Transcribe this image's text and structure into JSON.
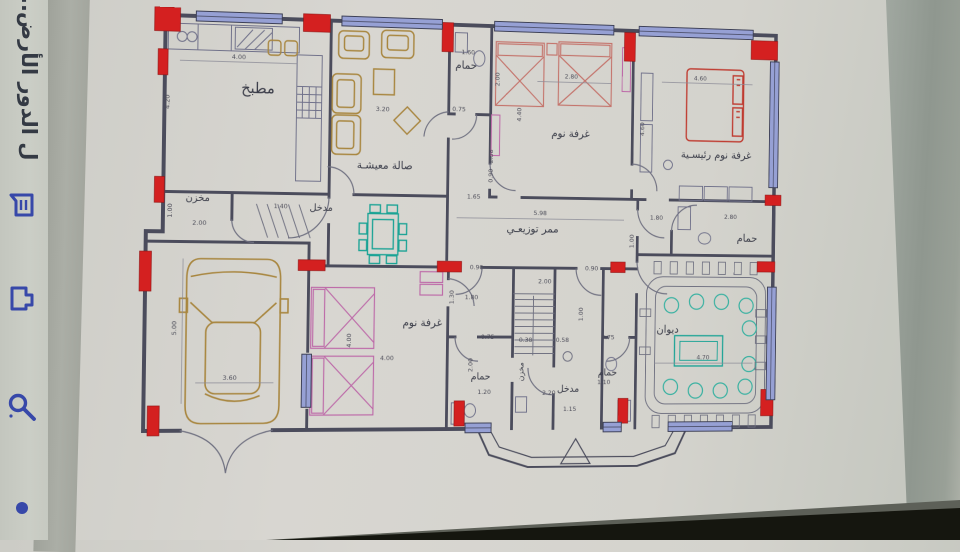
{
  "viewer": {
    "title_vertical": "ل الدور الأرض...",
    "icons": [
      {
        "name": "annotation-icon"
      },
      {
        "name": "share-icon"
      },
      {
        "name": "search-icon"
      },
      {
        "name": "dot-indicator"
      }
    ],
    "icon_color": "#3748a9"
  },
  "plan": {
    "rooms": [
      {
        "id": "kitchen",
        "label": "مطبخ",
        "x": 120,
        "y": 84,
        "s": 15,
        "r": 0
      },
      {
        "id": "living",
        "label": "صالة معيشـة",
        "x": 253,
        "y": 158,
        "s": 11,
        "r": 0
      },
      {
        "id": "bath-top",
        "label": "حمام",
        "x": 338,
        "y": 53,
        "s": 11,
        "r": 0
      },
      {
        "id": "bedroom-1",
        "label": "غرفة نوم",
        "x": 452,
        "y": 121,
        "s": 11,
        "r": 0
      },
      {
        "id": "master-bedroom",
        "label": "غرفة نوم رئيسـية",
        "x": 614,
        "y": 140,
        "s": 11,
        "r": 0
      },
      {
        "id": "store-1",
        "label": "مخزن",
        "x": 60,
        "y": 194,
        "s": 10,
        "r": 0
      },
      {
        "id": "entry-1",
        "label": "مدخل",
        "x": 187,
        "y": 202,
        "s": 10,
        "r": 0
      },
      {
        "id": "corridor",
        "label": "ممر توزيعـي",
        "x": 412,
        "y": 221,
        "s": 11,
        "r": 0
      },
      {
        "id": "bath-right",
        "label": "حمام",
        "x": 650,
        "y": 228,
        "s": 11,
        "r": 0
      },
      {
        "id": "bedroom-2",
        "label": "غرفة نوم",
        "x": 295,
        "y": 319,
        "s": 11,
        "r": 0
      },
      {
        "id": "diwan",
        "label": "ديوان",
        "x": 562,
        "y": 325,
        "s": 11,
        "r": 0
      },
      {
        "id": "bath-3",
        "label": "حمام",
        "x": 358,
        "y": 374,
        "s": 10,
        "r": 0
      },
      {
        "id": "store-2",
        "label": "مخزن",
        "x": 404,
        "y": 366,
        "s": 8,
        "r": -90
      },
      {
        "id": "entry-2",
        "label": "مدخل",
        "x": 453,
        "y": 387,
        "s": 10,
        "r": 0
      },
      {
        "id": "bath-4",
        "label": "حمام",
        "x": 496,
        "y": 370,
        "s": 10,
        "r": 0
      }
    ],
    "dims": [
      {
        "t": "4.00",
        "x": 100,
        "y": 50,
        "r": 0
      },
      {
        "t": "4.20",
        "x": 30,
        "y": 95,
        "r": 1
      },
      {
        "t": "3.20",
        "x": 250,
        "y": 99,
        "r": 0
      },
      {
        "t": "0.75",
        "x": 331,
        "y": 97,
        "r": 0
      },
      {
        "t": "1.60",
        "x": 340,
        "y": 38,
        "r": 0
      },
      {
        "t": "2.00",
        "x": 374,
        "y": 63,
        "r": 1
      },
      {
        "t": "2.80",
        "x": 452,
        "y": 60,
        "r": 0
      },
      {
        "t": "4.40",
        "x": 398,
        "y": 99,
        "r": 1
      },
      {
        "t": "2.38",
        "x": 368,
        "y": 143,
        "r": 1
      },
      {
        "t": "0.90",
        "x": 368,
        "y": 163,
        "r": 1
      },
      {
        "t": "4.60",
        "x": 595,
        "y": 58,
        "r": 0
      },
      {
        "t": "4.60",
        "x": 533,
        "y": 111,
        "r": 1
      },
      {
        "t": "1.00",
        "x": 34,
        "y": 204,
        "r": 1
      },
      {
        "t": "2.00",
        "x": 62,
        "y": 218,
        "r": 0
      },
      {
        "t": "1.40",
        "x": 145,
        "y": 200,
        "r": 0
      },
      {
        "t": "5.98",
        "x": 420,
        "y": 203,
        "r": 0
      },
      {
        "t": "1.65",
        "x": 348,
        "y": 187,
        "r": 0
      },
      {
        "t": "1.80",
        "x": 548,
        "y": 206,
        "r": 0
      },
      {
        "t": "2.80",
        "x": 631,
        "y": 204,
        "r": 0
      },
      {
        "t": "1.00",
        "x": 523,
        "y": 229,
        "r": 1
      },
      {
        "t": "0.90",
        "x": 352,
        "y": 260,
        "r": 0
      },
      {
        "t": "0.90",
        "x": 477,
        "y": 260,
        "r": 0
      },
      {
        "t": "2.00",
        "x": 426,
        "y": 274,
        "r": 0
      },
      {
        "t": "1.00",
        "x": 468,
        "y": 306,
        "r": 1
      },
      {
        "t": "5.00",
        "x": 40,
        "y": 322,
        "r": 1
      },
      {
        "t": "3.60",
        "x": 95,
        "y": 374,
        "r": 0
      },
      {
        "t": "4.00",
        "x": 220,
        "y": 334,
        "r": 1
      },
      {
        "t": "4.00",
        "x": 258,
        "y": 354,
        "r": 0
      },
      {
        "t": "0.75",
        "x": 365,
        "y": 332,
        "r": 0
      },
      {
        "t": "0.38",
        "x": 406,
        "y": 335,
        "r": 0
      },
      {
        "t": "0.58",
        "x": 446,
        "y": 335,
        "r": 0
      },
      {
        "t": "0.75",
        "x": 496,
        "y": 332,
        "r": 0
      },
      {
        "t": "1.20",
        "x": 362,
        "y": 389,
        "r": 0
      },
      {
        "t": "2.00",
        "x": 349,
        "y": 359,
        "r": 1
      },
      {
        "t": "2.20",
        "x": 432,
        "y": 390,
        "r": 0
      },
      {
        "t": "1.10",
        "x": 492,
        "y": 379,
        "r": 0
      },
      {
        "t": "1.15",
        "x": 455,
        "y": 407,
        "r": 0
      },
      {
        "t": "4.70",
        "x": 602,
        "y": 353,
        "r": 0
      },
      {
        "t": "1.30",
        "x": 328,
        "y": 289,
        "r": 1
      },
      {
        "t": "1.80",
        "x": 347,
        "y": 291,
        "r": 0
      }
    ],
    "colors": {
      "ink": "#4b4c5c",
      "column_red": "#d42020",
      "window_blue": "#96a0d4",
      "furniture_tan": "#a8863f",
      "bed_pink": "#bd6aa8",
      "bed_light_red": "#c4736b",
      "master_bed_red": "#bf3b30",
      "dining_teal": "#1ba395",
      "diwan_green": "#35b0a0"
    }
  }
}
